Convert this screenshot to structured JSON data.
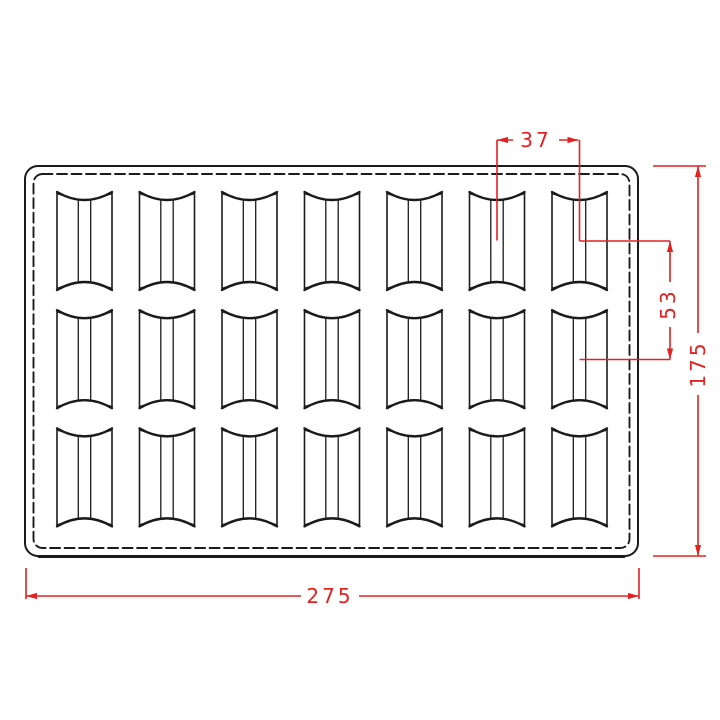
{
  "drawing": {
    "description": "Top view technical drawing of a rectangular 21-cavity tray mold with rounded corners and dashed inner outline",
    "grid": {
      "rows": 3,
      "columns": 7,
      "cavity_count": 21
    },
    "colors": {
      "line": "#1b1b1b",
      "dimension": "#e32120",
      "background": "#ffffff"
    }
  },
  "dimensions": {
    "width_label": "275",
    "height_label": "175",
    "pitch_x_label": "37",
    "pitch_y_label": "53"
  }
}
